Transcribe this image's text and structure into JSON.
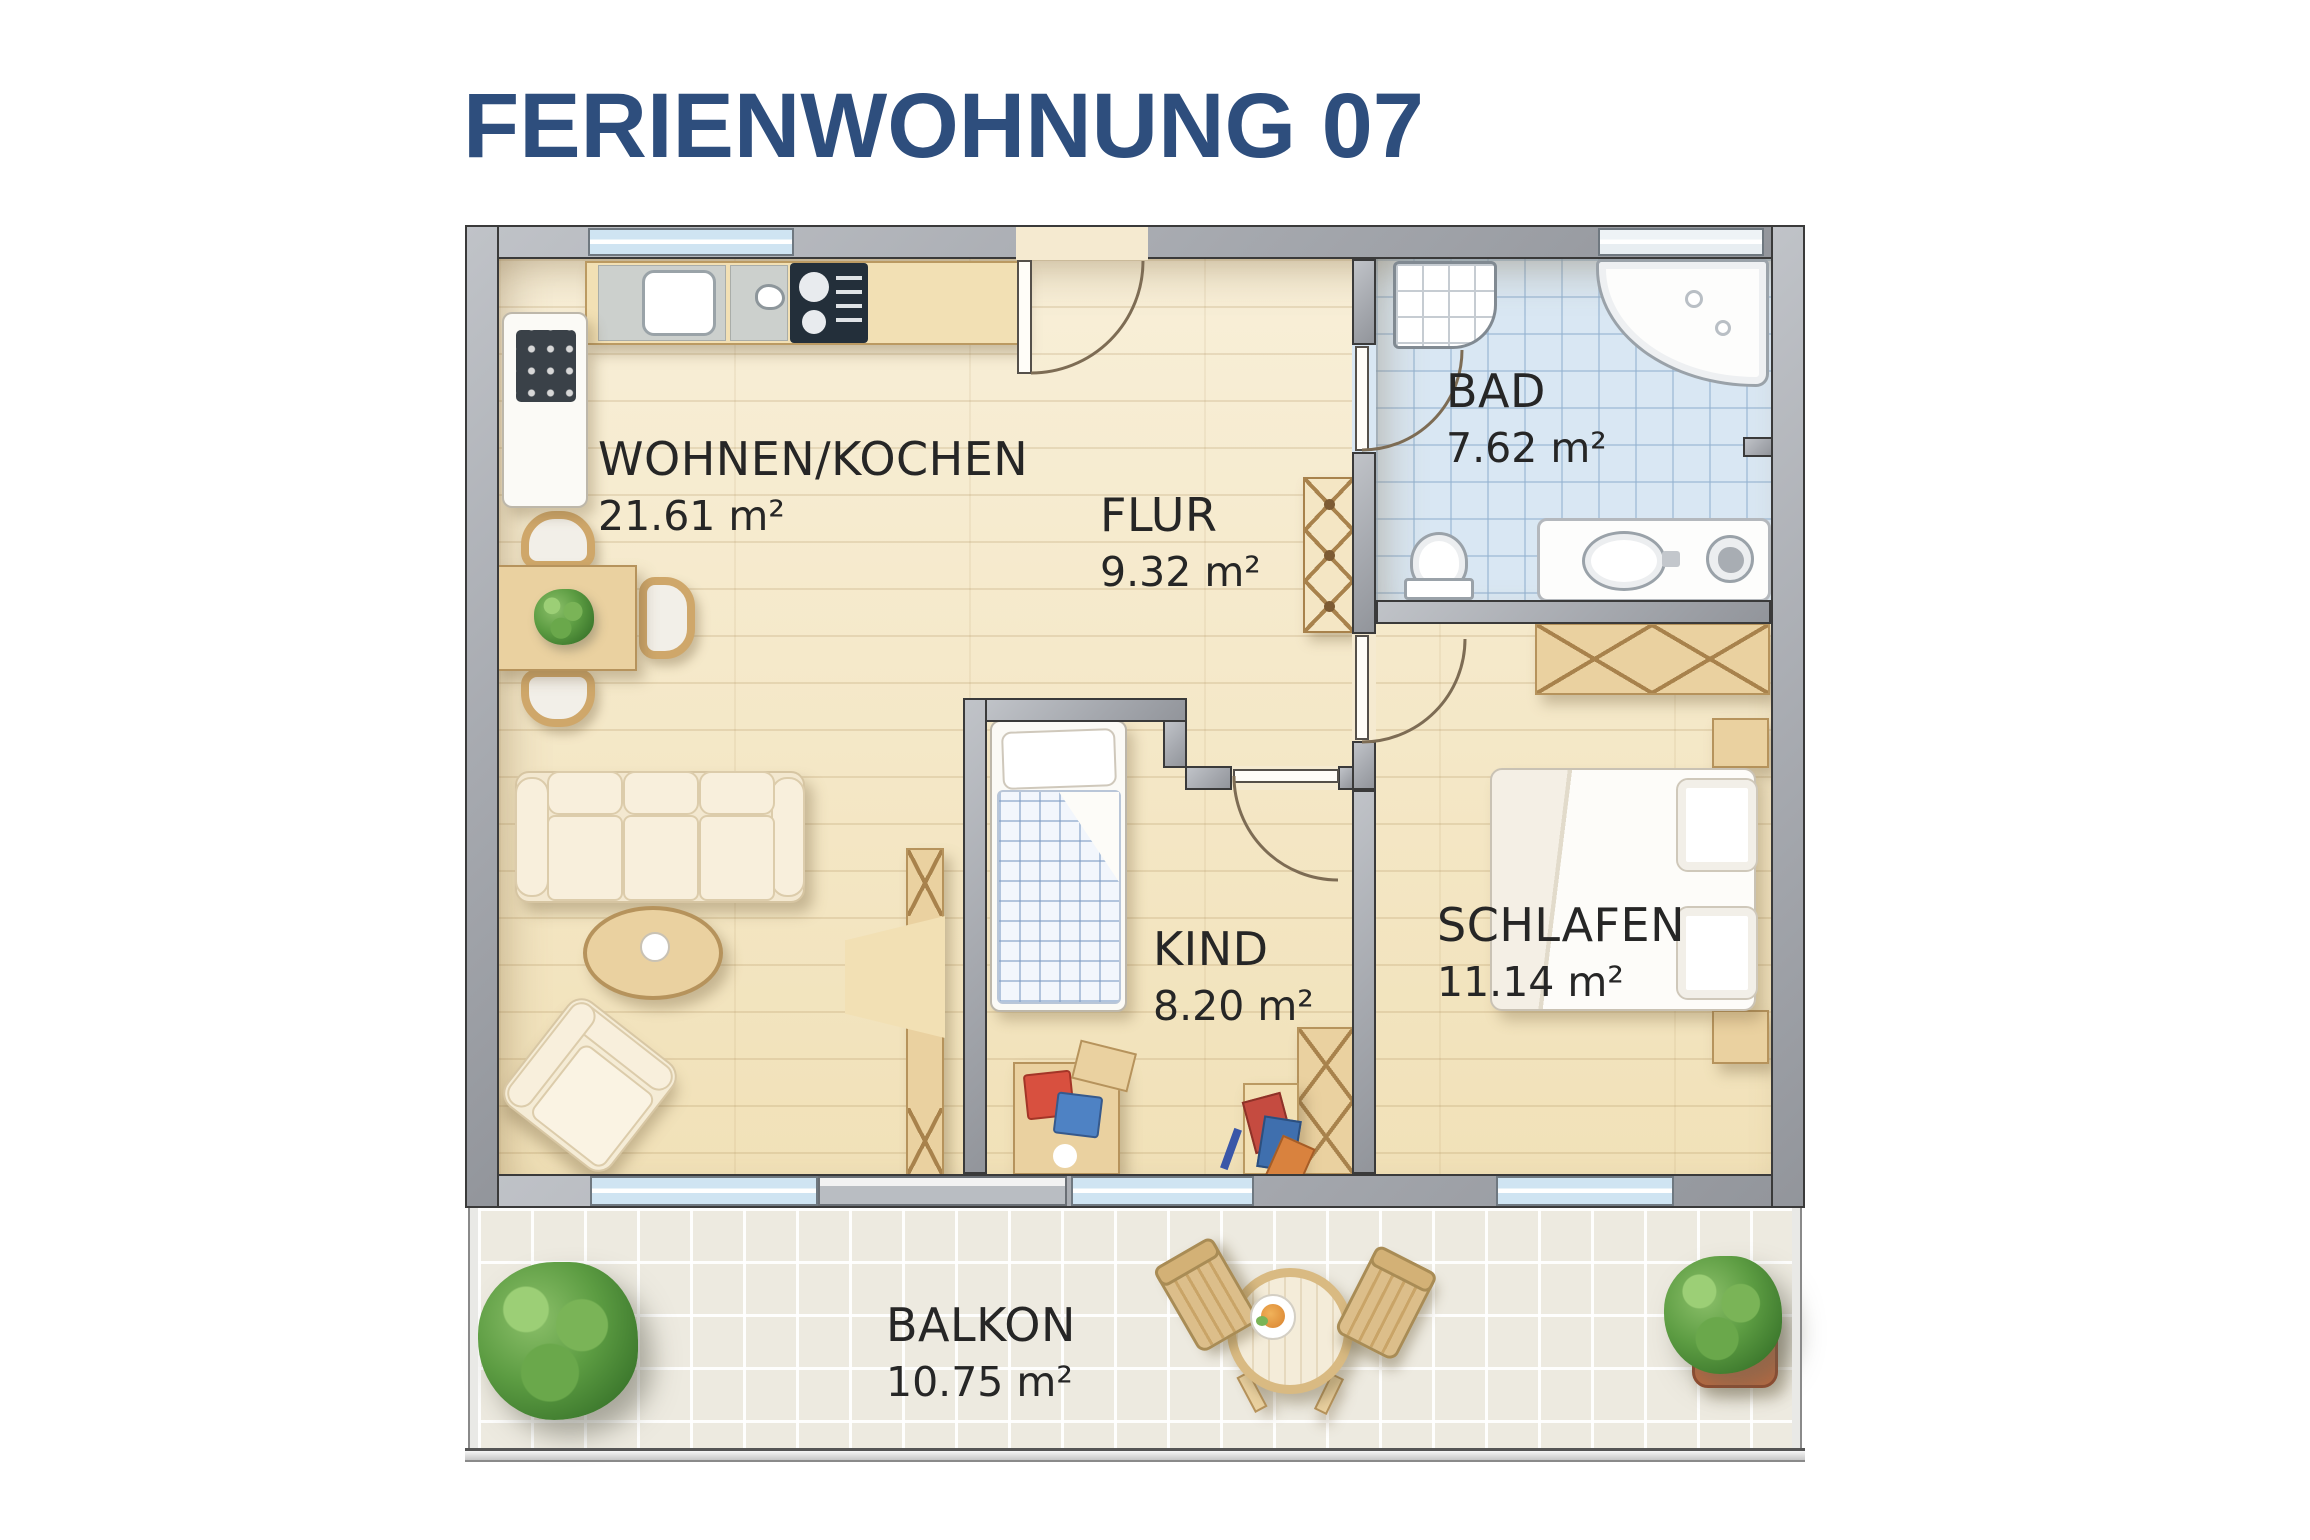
{
  "title": "FERIENWOHNUNG 07",
  "rooms": [
    {
      "id": "wohnen-kochen",
      "name": "WOHNEN/KOCHEN",
      "area": "21.61 m²"
    },
    {
      "id": "flur",
      "name": "FLUR",
      "area": "9.32 m²"
    },
    {
      "id": "bad",
      "name": "BAD",
      "area": "7.62 m²"
    },
    {
      "id": "kind",
      "name": "KIND",
      "area": "8.20 m²"
    },
    {
      "id": "schlafen",
      "name": "SCHLAFEN",
      "area": "11.14 m²"
    },
    {
      "id": "balkon",
      "name": "BALKON",
      "area": "10.75 m²"
    }
  ],
  "colors": {
    "title_blue": "#2e4e7d",
    "wall_gray": "#a6a9af",
    "wood_floor": "#f5e9cb",
    "bath_tiles": "#d9e7f3",
    "balcony_tiles": "#edeae0",
    "window_glass": "#cfe4f2",
    "furniture_wood": "#e7c896"
  }
}
